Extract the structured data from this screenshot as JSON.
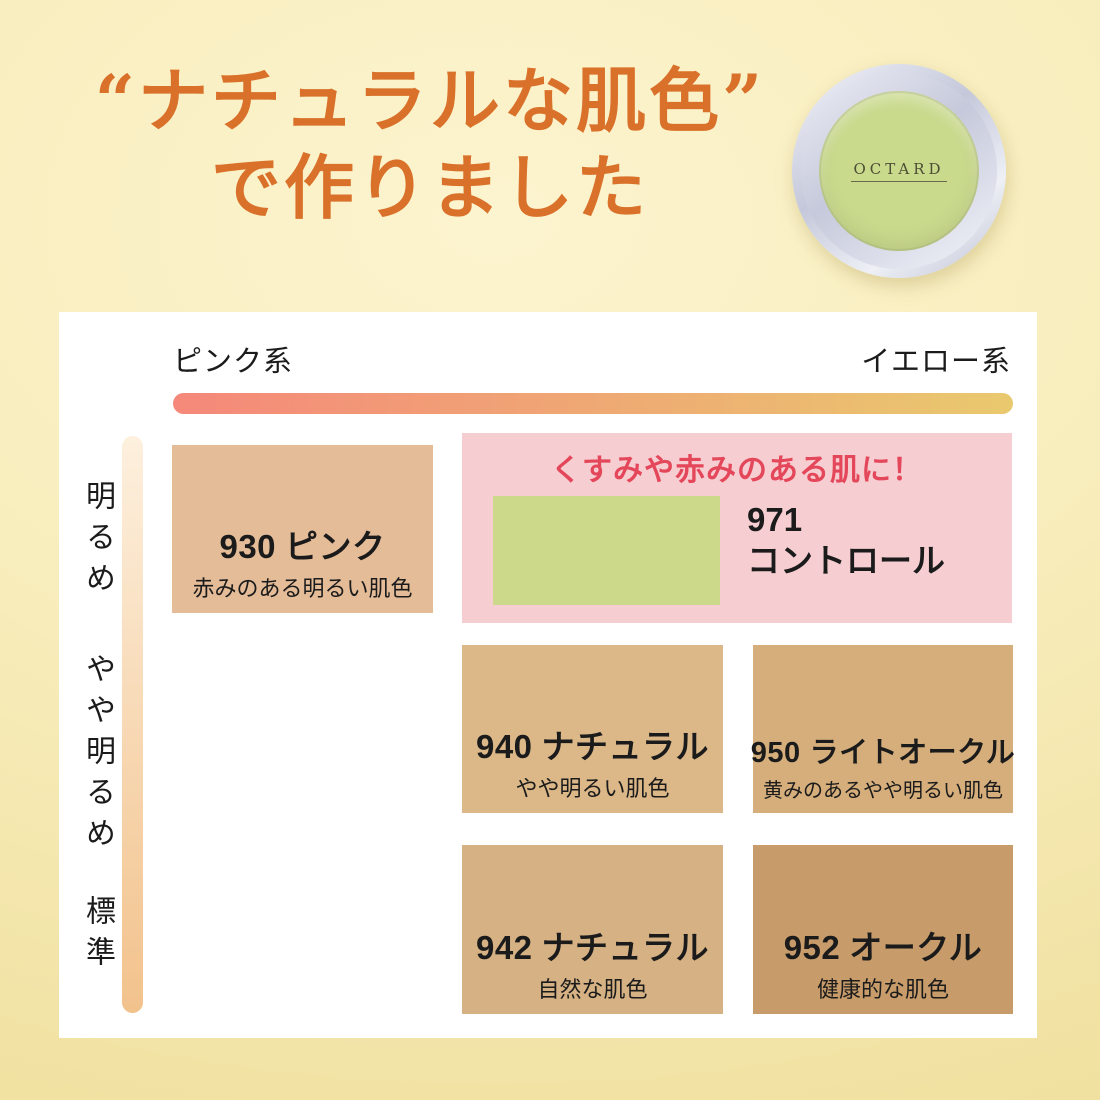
{
  "title": {
    "line1": "“ナチュラルな肌色”",
    "line2": "で作りました",
    "color": "#d9712a"
  },
  "product": {
    "brand": "OCTARD",
    "powder_color": "#c9da8d"
  },
  "chart": {
    "x_left_label": "ピンク系",
    "x_right_label": "イエロー系",
    "y_labels": [
      "明るめ",
      "やや明るめ",
      "標準"
    ],
    "tone_bar": {
      "pink_color": "#f5887a",
      "yellow_color": "#e9c96e"
    },
    "brightness_bar": {
      "top_color": "#fdf0de",
      "bottom_color": "#f2c28c"
    },
    "callout": {
      "heading": "くすみや赤みのある肌に！",
      "heading_color": "#e4465a",
      "bg_color": "#f6ced2",
      "shade": {
        "code": "971",
        "name": "コントロール",
        "color": "#ccd98b"
      }
    },
    "shades": [
      {
        "code": "930",
        "name": "ピンク",
        "desc": "赤みのある明るい肌色",
        "color": "#e5bc98"
      },
      {
        "code": "940",
        "name": "ナチュラル",
        "desc": "やや明るい肌色",
        "color": "#dcb888"
      },
      {
        "code": "950",
        "name": "ライトオークル",
        "desc": "黄みのあるやや明るい肌色",
        "color": "#d5ae7c"
      },
      {
        "code": "942",
        "name": "ナチュラル",
        "desc": "自然な肌色",
        "color": "#d5b183"
      },
      {
        "code": "952",
        "name": "オークル",
        "desc": "健康的な肌色",
        "color": "#c89c6a"
      }
    ]
  }
}
